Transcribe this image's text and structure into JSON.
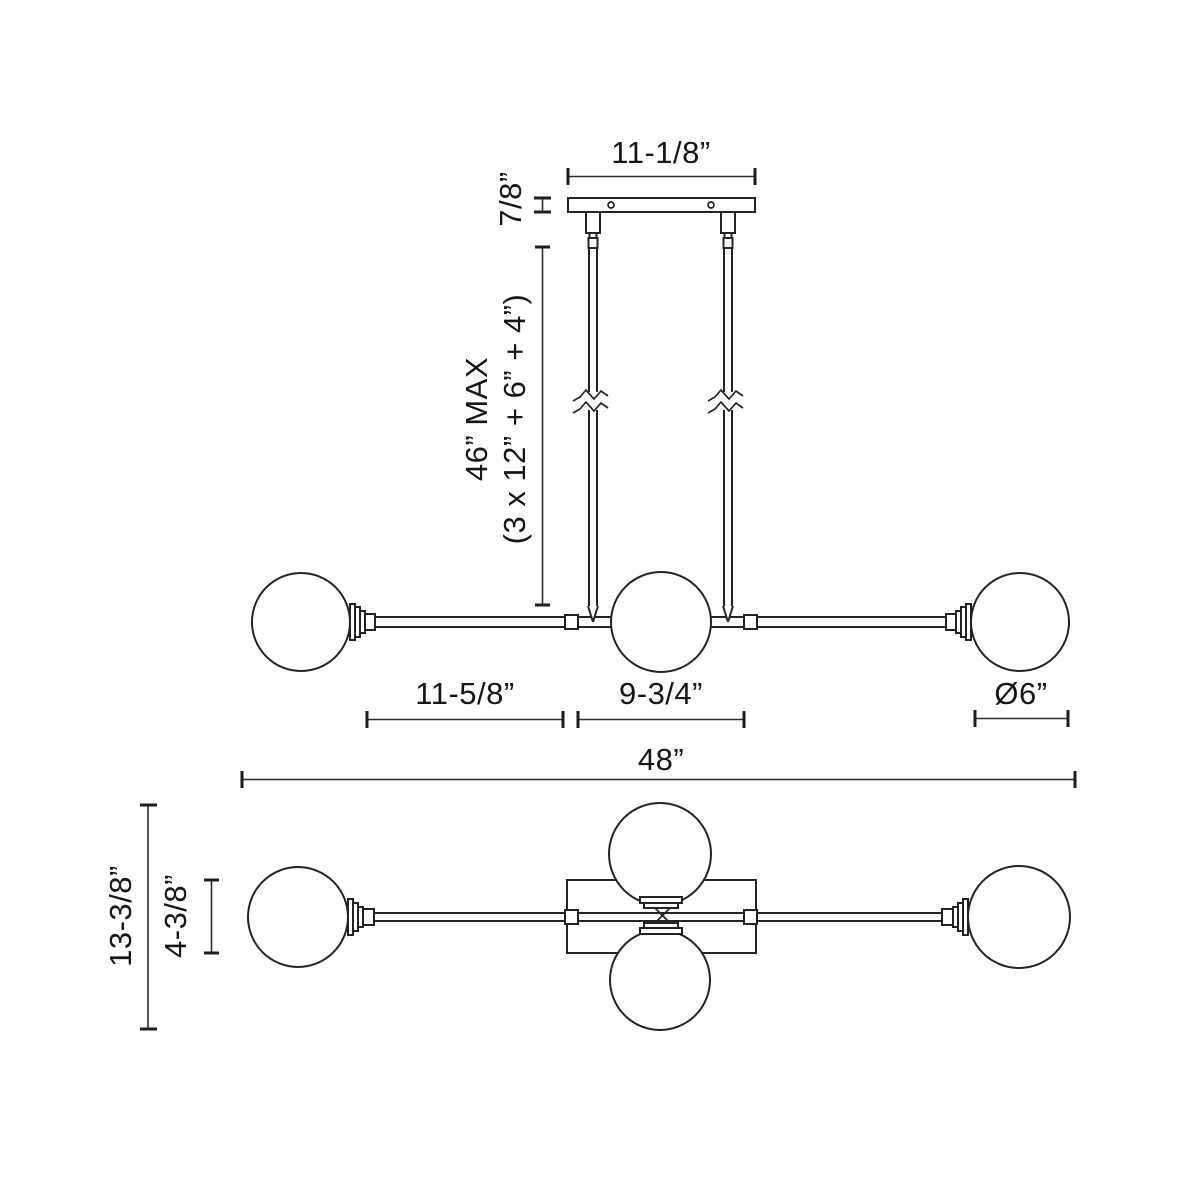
{
  "diagram": {
    "kind": "lighting-fixture-dimension-drawing",
    "background_color": "#ffffff",
    "line_color": "#232323",
    "text_color": "#161616",
    "front_view": {
      "canopy_width": "11-1/8”",
      "canopy_height": "7/8”",
      "suspension_max_line1": "46” MAX",
      "suspension_max_line2": "(3 x 12” + 6” + 4”)",
      "left_arm_length": "11-5/8”",
      "center_span": "9-3/4”",
      "globe_diameter": "Ø6”",
      "overall_width": "48”"
    },
    "plan_view": {
      "overall_depth": "13-3/8”",
      "canopy_depth": "4-3/8”"
    }
  }
}
